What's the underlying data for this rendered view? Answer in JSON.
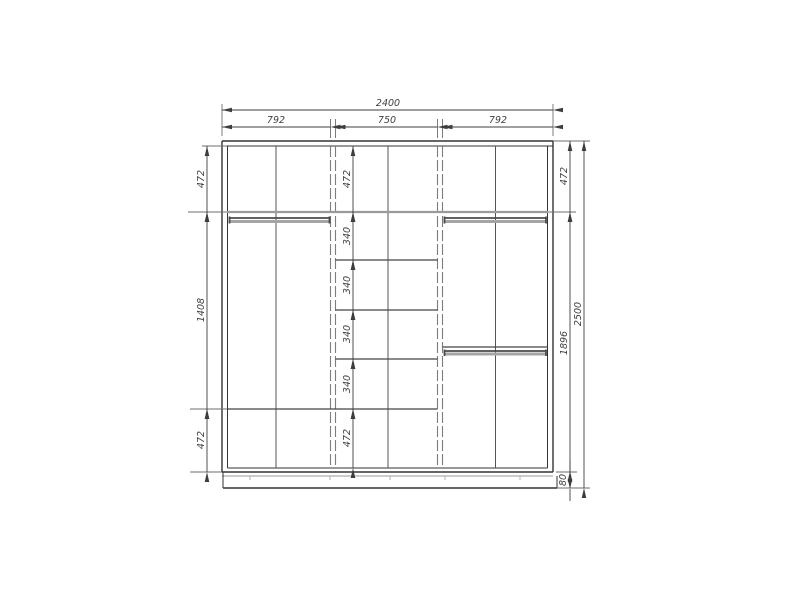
{
  "drawing": {
    "kind": "wardrobe-front-elevation",
    "colors": {
      "background": "#ffffff",
      "main_line": "#333333",
      "dimension_line": "#3d3d3d",
      "light_line": "#9a9a9a"
    }
  },
  "dims": {
    "overall_width": "2400",
    "overall_height": "2500",
    "top": [
      "792",
      "750",
      "792"
    ],
    "left": [
      "472",
      "1408",
      "472"
    ],
    "middle": [
      "472",
      "340",
      "340",
      "340",
      "340",
      "472"
    ],
    "right": [
      "472",
      "1896",
      "80"
    ]
  }
}
